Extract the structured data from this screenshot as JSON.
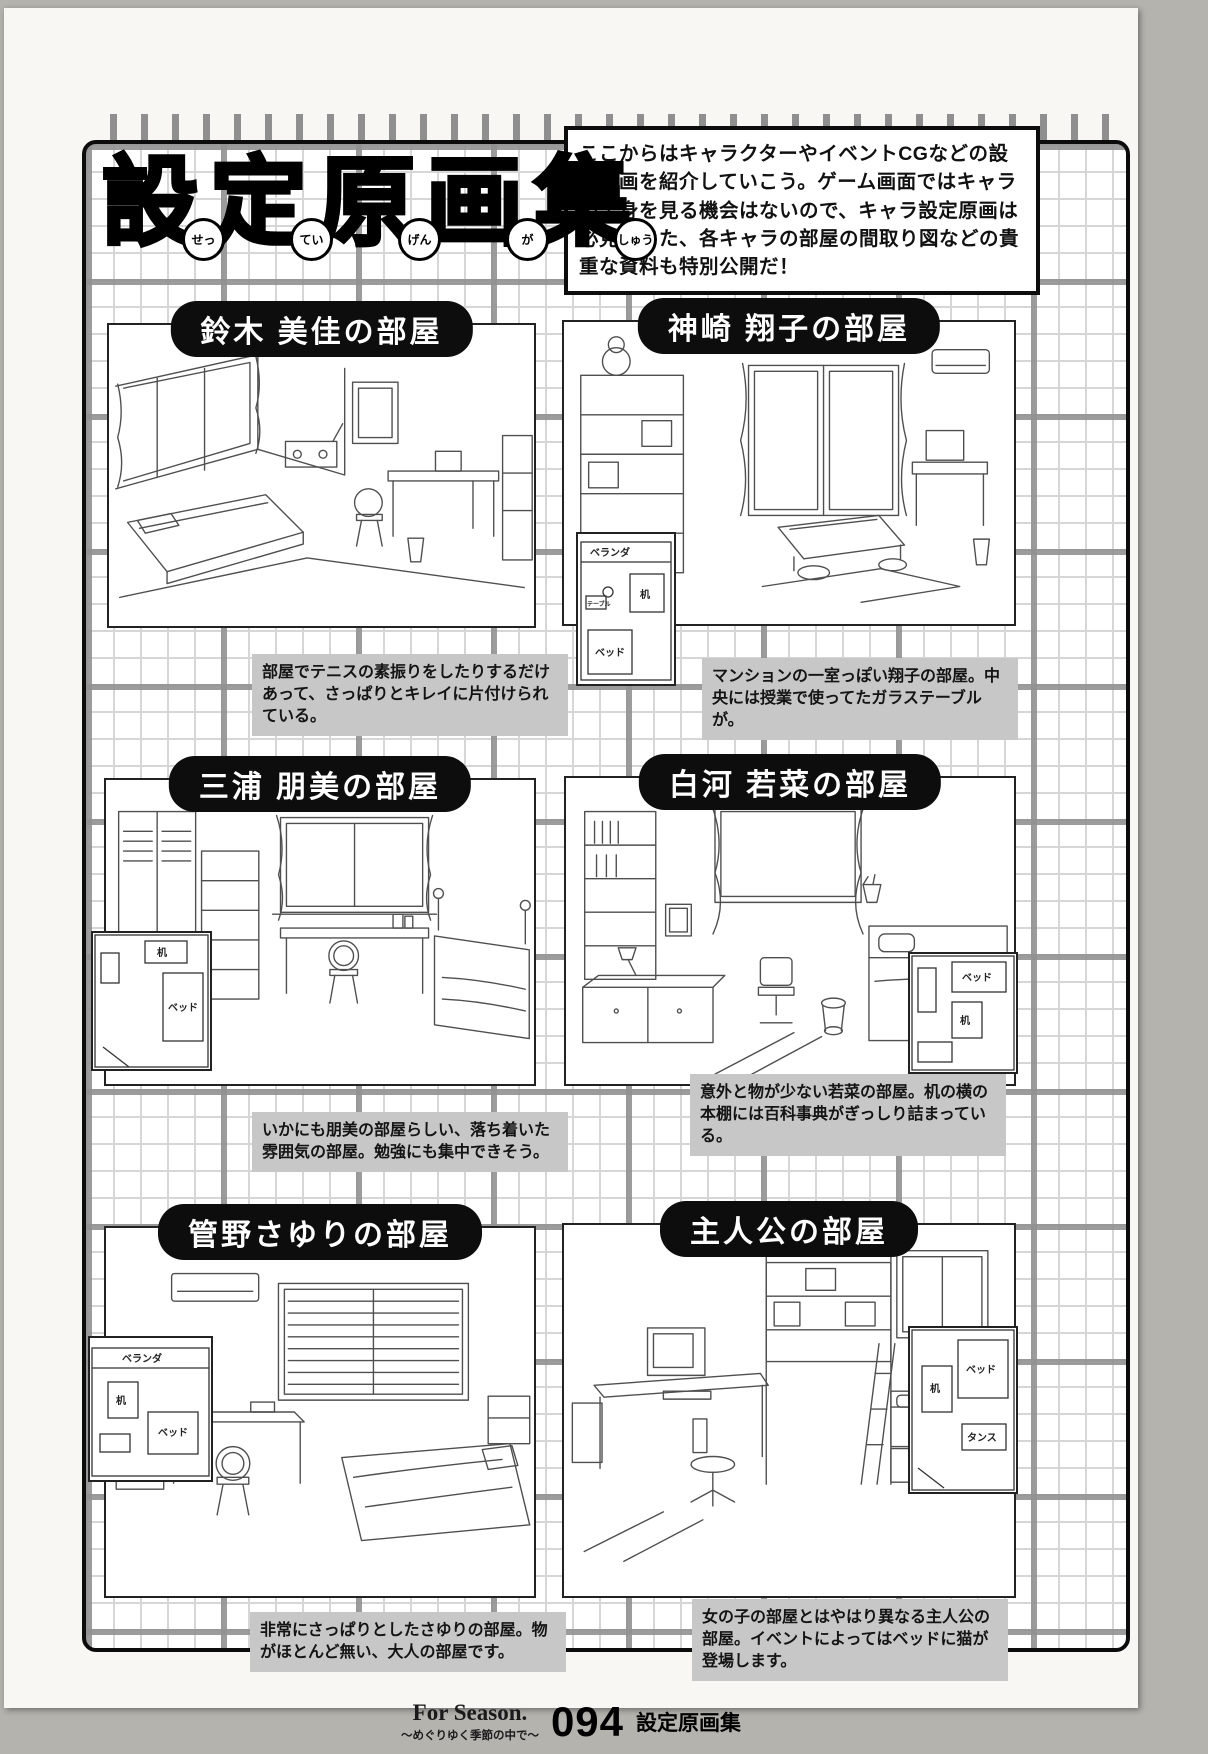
{
  "header": {
    "logo": {
      "kanji": [
        "設",
        "定",
        "原",
        "画",
        "集"
      ],
      "furigana": [
        "せっ",
        "てい",
        "げん",
        "が",
        "しゅう"
      ]
    },
    "intro": "ここからはキャラクターやイベントCGなどの設定原画を紹介していこう。ゲーム画面ではキャラの全身を見る機会はないので、キャラ設定原画は必見。また、各キャラの部屋の間取り図などの貴重な資料も特別公開だ！"
  },
  "panels": [
    {
      "title": "鈴木 美佳の部屋",
      "caption": "部屋でテニスの素振りをしたりするだけあって、さっぱりとキレイに片付けられている。"
    },
    {
      "title": "神崎 翔子の部屋",
      "caption": "マンションの一室っぽい翔子の部屋。中央には授業で使ってたガラステーブルが。",
      "plan": [
        "ベランダ",
        "机",
        "テーブル",
        "ベッド"
      ]
    },
    {
      "title": "三浦 朋美の部屋",
      "caption": "いかにも朋美の部屋らしい、落ち着いた雰囲気の部屋。勉強にも集中できそう。",
      "plan": [
        "机",
        "ベッド"
      ]
    },
    {
      "title": "白河 若菜の部屋",
      "caption": "意外と物が少ない若菜の部屋。机の横の本棚には百科事典がぎっしり詰まっている。",
      "plan": [
        "ベッド",
        "机"
      ]
    },
    {
      "title": "管野さゆりの部屋",
      "caption": "非常にさっぱりとしたさゆりの部屋。物がほとんど無い、大人の部屋です。",
      "plan": [
        "ベランダ",
        "机",
        "ベッド"
      ]
    },
    {
      "title": "主人公の部屋",
      "caption": "女の子の部屋とはやはり異なる主人公の部屋。イベントによってはベッドに猫が登場します。",
      "plan": [
        "ベッド",
        "机",
        "タンス"
      ]
    }
  ],
  "footer": {
    "brand": "For Season.",
    "tagline": "～めぐりゆく季節の中で～",
    "page_number": "094",
    "section": "設定原画集"
  }
}
